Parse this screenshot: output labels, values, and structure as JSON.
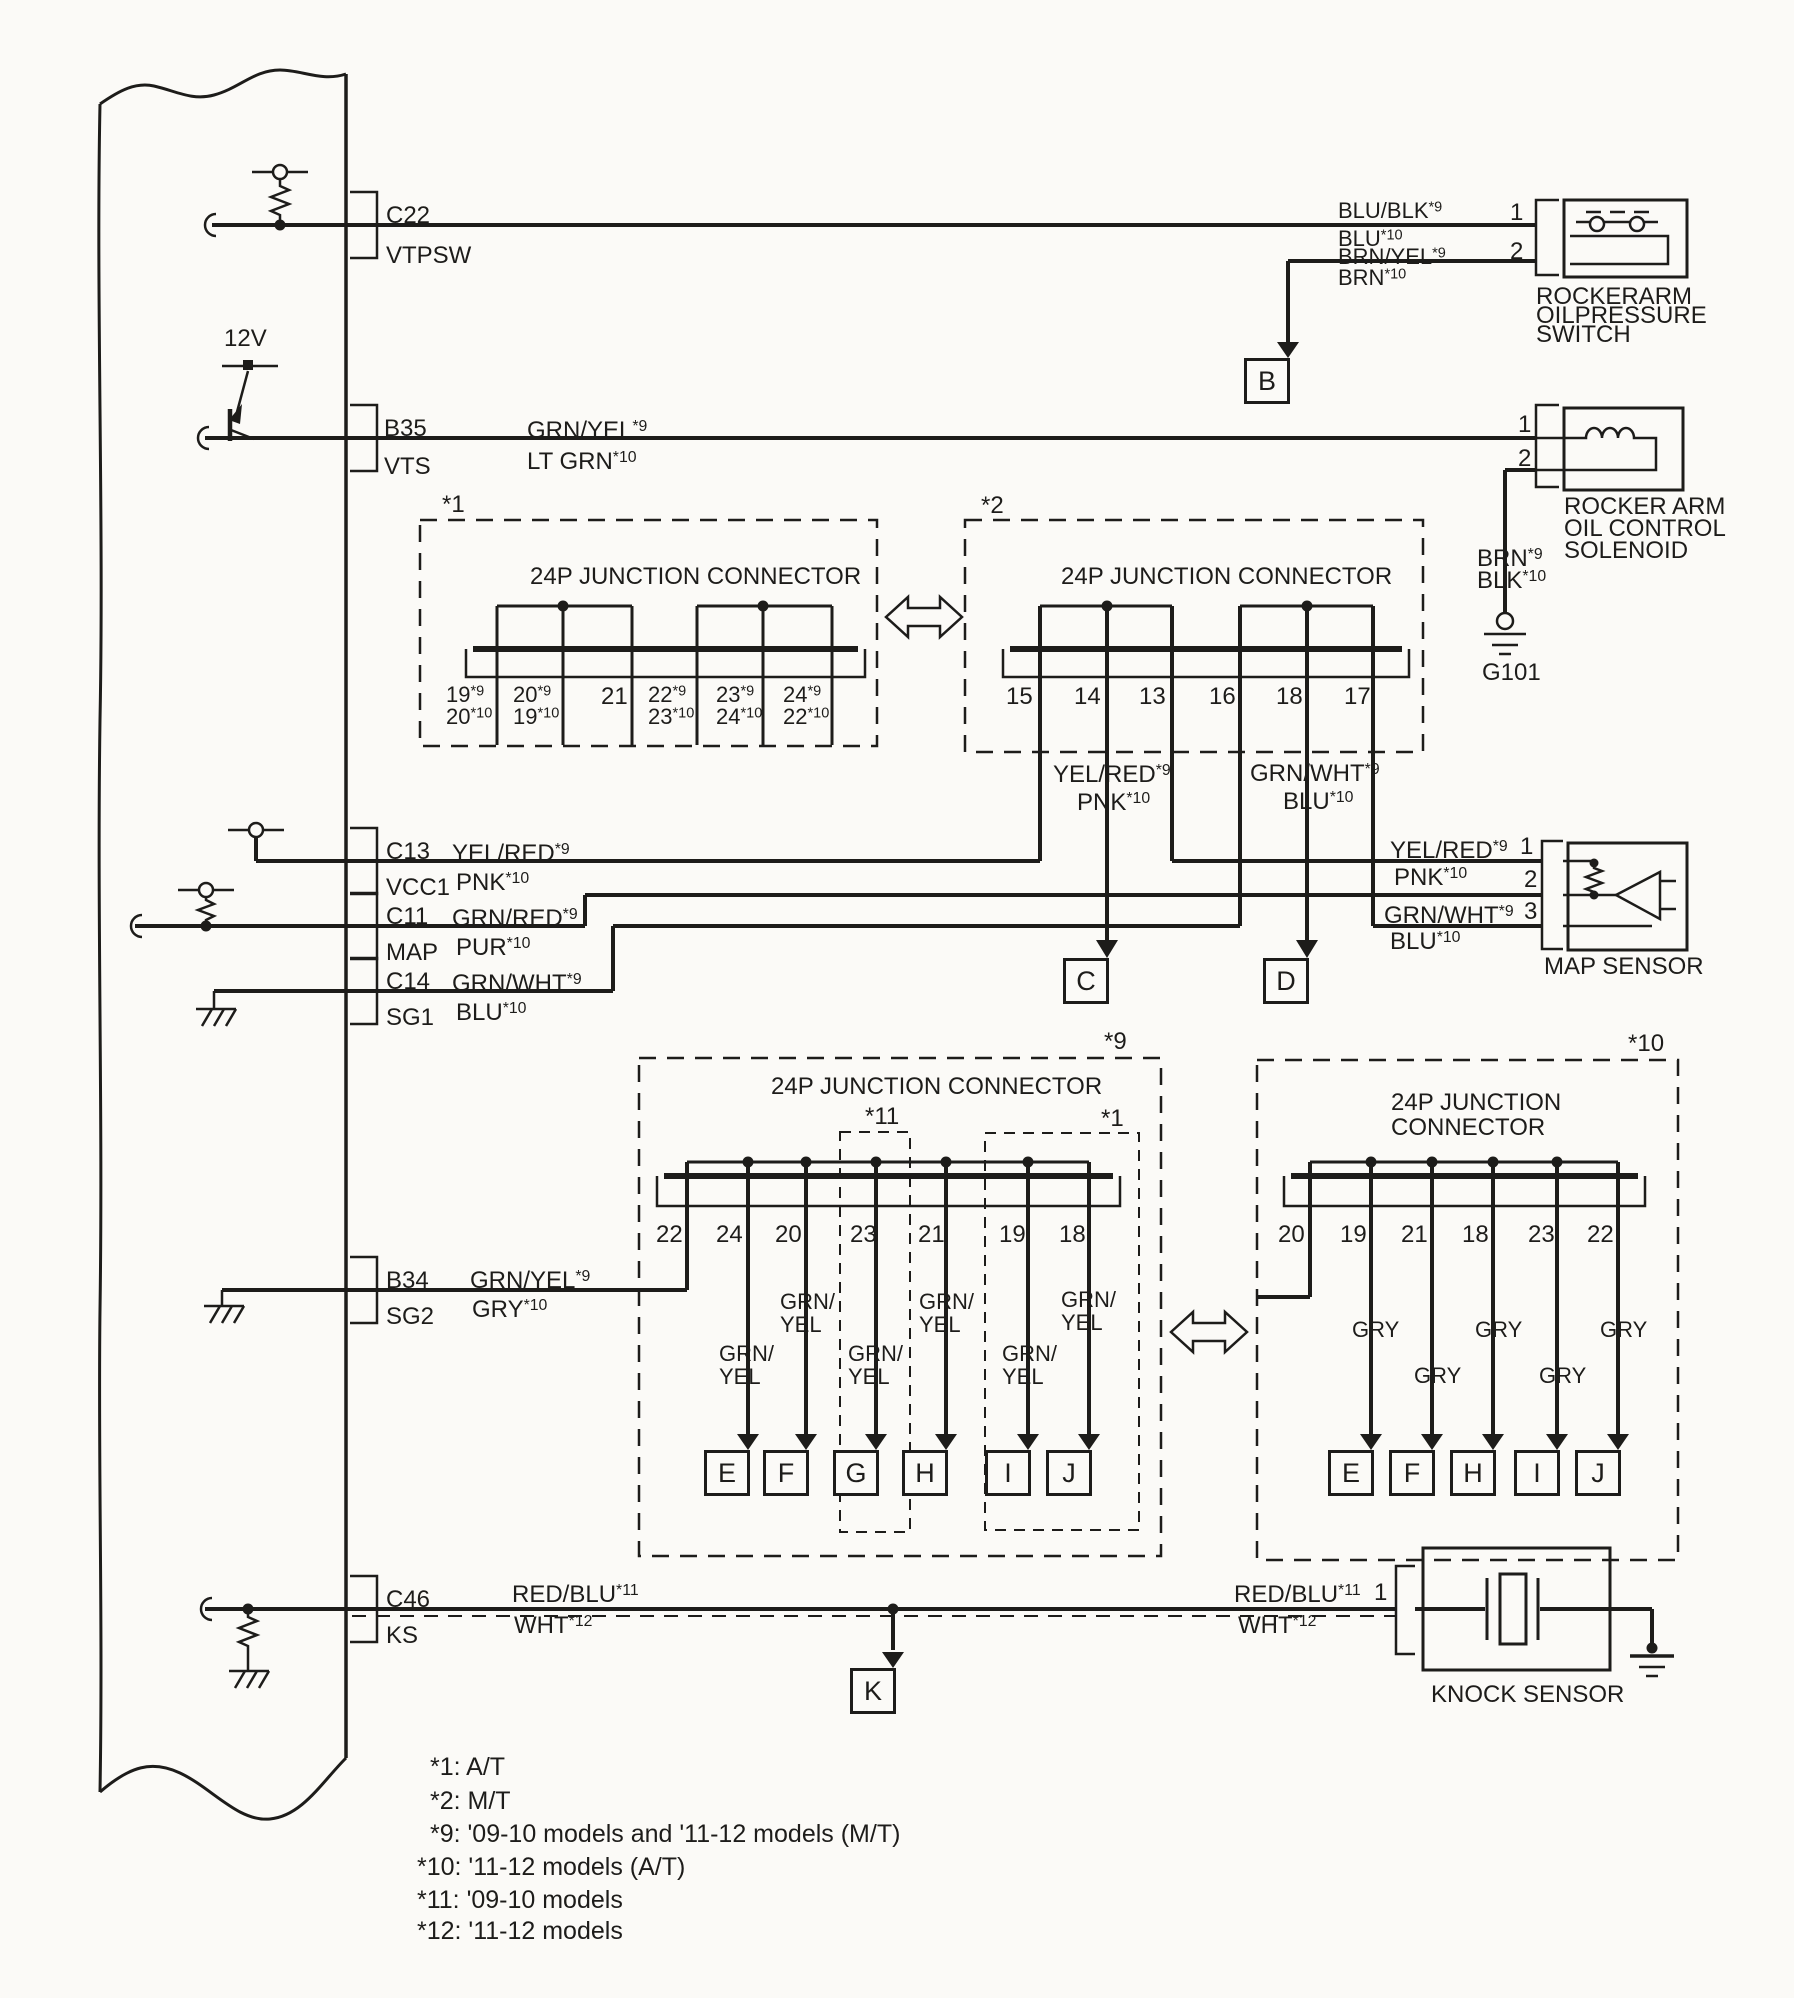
{
  "canvas": {
    "width": 1794,
    "height": 1998,
    "bg": "#fbfaf7",
    "ink": "#1d1c1a"
  },
  "labels": [
    {
      "n": "ecm-pin-c22-id",
      "t": "C22",
      "x": 386,
      "y": 203
    },
    {
      "n": "ecm-pin-c22-name",
      "t": "VTPSW",
      "x": 386,
      "y": 243
    },
    {
      "n": "supply-12v-label",
      "t": "12V",
      "x": 224,
      "y": 326
    },
    {
      "n": "ecm-pin-b35-id",
      "t": "B35",
      "x": 384,
      "y": 416
    },
    {
      "n": "ecm-pin-b35-name",
      "t": "VTS",
      "x": 384,
      "y": 454
    },
    {
      "n": "ecm-pin-c13-id",
      "t": "C13",
      "x": 386,
      "y": 839
    },
    {
      "n": "ecm-pin-c13-name",
      "t": "VCC1",
      "x": 386,
      "y": 875
    },
    {
      "n": "ecm-pin-c11-id",
      "t": "C11",
      "x": 386,
      "y": 904
    },
    {
      "n": "ecm-pin-c11-name",
      "t": "MAP",
      "x": 386,
      "y": 940
    },
    {
      "n": "ecm-pin-c14-id",
      "t": "C14",
      "x": 386,
      "y": 969
    },
    {
      "n": "ecm-pin-c14-name",
      "t": "SG1",
      "x": 386,
      "y": 1005
    },
    {
      "n": "ecm-pin-b34-id",
      "t": "B34",
      "x": 386,
      "y": 1268
    },
    {
      "n": "ecm-pin-b34-name",
      "t": "SG2",
      "x": 386,
      "y": 1304
    },
    {
      "n": "ecm-pin-c46-id",
      "t": "C46",
      "x": 386,
      "y": 1587
    },
    {
      "n": "ecm-pin-c46-name",
      "t": "KS",
      "x": 386,
      "y": 1623
    },
    {
      "n": "wire-vts-color-1",
      "t": "GRN/YEL*9",
      "x": 527,
      "y": 418
    },
    {
      "n": "wire-vts-color-2",
      "t": "LT GRN*10",
      "x": 527,
      "y": 449
    },
    {
      "n": "wire-vcc1-color-1",
      "t": "YEL/RED*9",
      "x": 452,
      "y": 841
    },
    {
      "n": "wire-vcc1-color-2",
      "t": "PNK*10",
      "x": 456,
      "y": 870
    },
    {
      "n": "wire-map-color-1",
      "t": "GRN/RED*9",
      "x": 452,
      "y": 906
    },
    {
      "n": "wire-map-color-2",
      "t": "PUR*10",
      "x": 456,
      "y": 935
    },
    {
      "n": "wire-sg1-color-1",
      "t": "GRN/WHT*9",
      "x": 452,
      "y": 971
    },
    {
      "n": "wire-sg1-color-2",
      "t": "BLU*10",
      "x": 456,
      "y": 1000
    },
    {
      "n": "wire-sg2-color-1",
      "t": "GRN/YEL*9",
      "x": 470,
      "y": 1268
    },
    {
      "n": "wire-sg2-color-2",
      "t": "GRY*10",
      "x": 472,
      "y": 1297
    },
    {
      "n": "wire-ks-color-1",
      "t": "RED/BLU*11",
      "x": 512,
      "y": 1582
    },
    {
      "n": "wire-ks-color-2",
      "t": "WHT*12",
      "x": 514,
      "y": 1613
    },
    {
      "n": "wire-vtpsw-color-1",
      "t": "BLU/BLK*9",
      "x": 1338,
      "y": 199,
      "s": 22
    },
    {
      "n": "wire-vtpsw-color-2",
      "t": "BLU*10",
      "x": 1338,
      "y": 227,
      "s": 22
    },
    {
      "n": "wire-vtpsw-color-3",
      "t": "BRN/YEL*9",
      "x": 1338,
      "y": 245,
      "s": 22
    },
    {
      "n": "wire-vtpsw-color-4",
      "t": "BRN*10",
      "x": 1338,
      "y": 266,
      "s": 22
    },
    {
      "n": "switch-pin-1",
      "t": "1",
      "x": 1510,
      "y": 200
    },
    {
      "n": "switch-pin-2",
      "t": "2",
      "x": 1510,
      "y": 239
    },
    {
      "n": "switch-caption-1",
      "t": "ROCKERARM",
      "x": 1536,
      "y": 284
    },
    {
      "n": "switch-caption-2",
      "t": "OILPRESSURE",
      "x": 1536,
      "y": 303
    },
    {
      "n": "switch-caption-3",
      "t": "SWITCH",
      "x": 1536,
      "y": 322
    },
    {
      "n": "solenoid-pin-1",
      "t": "1",
      "x": 1518,
      "y": 412
    },
    {
      "n": "solenoid-pin-2",
      "t": "2",
      "x": 1518,
      "y": 446
    },
    {
      "n": "solenoid-caption-1",
      "t": "ROCKER ARM",
      "x": 1564,
      "y": 494
    },
    {
      "n": "solenoid-caption-2",
      "t": "OIL CONTROL",
      "x": 1564,
      "y": 516
    },
    {
      "n": "solenoid-caption-3",
      "t": "SOLENOID",
      "x": 1564,
      "y": 538
    },
    {
      "n": "wire-solenoid-color-1",
      "t": "BRN*9",
      "x": 1477,
      "y": 546
    },
    {
      "n": "wire-solenoid-color-2",
      "t": "BLK*10",
      "x": 1477,
      "y": 568
    },
    {
      "n": "ground-g101-label",
      "t": "G101",
      "x": 1482,
      "y": 660
    },
    {
      "n": "jc1-tag",
      "t": "*1",
      "x": 442,
      "y": 492
    },
    {
      "n": "jc1-title",
      "t": "24P JUNCTION CONNECTOR",
      "x": 530,
      "y": 564
    },
    {
      "n": "jc1-pin-1",
      "t": "19*9\n20*10",
      "x": 446,
      "y": 684,
      "s": 22,
      "lh": 22
    },
    {
      "n": "jc1-pin-2",
      "t": "20*9\n19*10",
      "x": 513,
      "y": 684,
      "s": 22,
      "lh": 22
    },
    {
      "n": "jc1-pin-3",
      "t": "21",
      "x": 601,
      "y": 684,
      "s": 24
    },
    {
      "n": "jc1-pin-4",
      "t": "22*9\n23*10",
      "x": 648,
      "y": 684,
      "s": 22,
      "lh": 22
    },
    {
      "n": "jc1-pin-5",
      "t": "23*9\n24*10",
      "x": 716,
      "y": 684,
      "s": 22,
      "lh": 22
    },
    {
      "n": "jc1-pin-6",
      "t": "24*9\n22*10",
      "x": 783,
      "y": 684,
      "s": 22,
      "lh": 22
    },
    {
      "n": "jc2-tag",
      "t": "*2",
      "x": 981,
      "y": 493
    },
    {
      "n": "jc2-title",
      "t": "24P JUNCTION CONNECTOR",
      "x": 1061,
      "y": 564
    },
    {
      "n": "jc2-pin-15",
      "t": "15",
      "x": 1006,
      "y": 684
    },
    {
      "n": "jc2-pin-14",
      "t": "14",
      "x": 1074,
      "y": 684
    },
    {
      "n": "jc2-pin-13",
      "t": "13",
      "x": 1139,
      "y": 684
    },
    {
      "n": "jc2-pin-16",
      "t": "16",
      "x": 1209,
      "y": 684
    },
    {
      "n": "jc2-pin-18",
      "t": "18",
      "x": 1276,
      "y": 684
    },
    {
      "n": "jc2-pin-17",
      "t": "17",
      "x": 1344,
      "y": 684
    },
    {
      "n": "wire-jc2-c-1",
      "t": "YEL/RED*9",
      "x": 1053,
      "y": 762
    },
    {
      "n": "wire-jc2-c-2",
      "t": "PNK*10",
      "x": 1077,
      "y": 790
    },
    {
      "n": "wire-jc2-d-1",
      "t": "GRN/WHT*9",
      "x": 1250,
      "y": 761
    },
    {
      "n": "wire-jc2-d-2",
      "t": "BLU*10",
      "x": 1283,
      "y": 789
    },
    {
      "n": "wire-map1-color-1",
      "t": "YEL/RED*9",
      "x": 1390,
      "y": 838
    },
    {
      "n": "wire-map1-color-2",
      "t": "PNK*10",
      "x": 1394,
      "y": 865
    },
    {
      "n": "wire-map3-color-1",
      "t": "GRN/WHT*9",
      "x": 1384,
      "y": 903
    },
    {
      "n": "wire-map3-color-2",
      "t": "BLU*10",
      "x": 1390,
      "y": 929
    },
    {
      "n": "map-pin-1",
      "t": "1",
      "x": 1520,
      "y": 834
    },
    {
      "n": "map-pin-2",
      "t": "2",
      "x": 1524,
      "y": 867
    },
    {
      "n": "map-pin-3",
      "t": "3",
      "x": 1524,
      "y": 899
    },
    {
      "n": "map-caption",
      "t": "MAP SENSOR",
      "x": 1544,
      "y": 954
    },
    {
      "n": "jc9-tag",
      "t": "*9",
      "x": 1104,
      "y": 1029
    },
    {
      "n": "jc9-title",
      "t": "24P JUNCTION CONNECTOR",
      "x": 771,
      "y": 1074
    },
    {
      "n": "jc9-sub11-tag",
      "t": "*11",
      "x": 865,
      "y": 1104
    },
    {
      "n": "jc9-sub1-tag",
      "t": "*1",
      "x": 1101,
      "y": 1106
    },
    {
      "n": "jc9-pin-22",
      "t": "22",
      "x": 656,
      "y": 1222
    },
    {
      "n": "jc9-pin-24",
      "t": "24",
      "x": 716,
      "y": 1222
    },
    {
      "n": "jc9-pin-20",
      "t": "20",
      "x": 775,
      "y": 1222
    },
    {
      "n": "jc9-pin-23",
      "t": "23",
      "x": 850,
      "y": 1222
    },
    {
      "n": "jc9-pin-21",
      "t": "21",
      "x": 918,
      "y": 1222
    },
    {
      "n": "jc9-pin-19",
      "t": "19",
      "x": 999,
      "y": 1222
    },
    {
      "n": "jc9-pin-18",
      "t": "18",
      "x": 1059,
      "y": 1222
    },
    {
      "n": "wire-jc9-e",
      "t": "GRN/\nYEL",
      "x": 719,
      "y": 1342,
      "s": 22,
      "lh": 23
    },
    {
      "n": "wire-jc9-f",
      "t": "GRN/\nYEL",
      "x": 780,
      "y": 1290,
      "s": 22,
      "lh": 23
    },
    {
      "n": "wire-jc9-g",
      "t": "GRN/\nYEL",
      "x": 848,
      "y": 1342,
      "s": 22,
      "lh": 23
    },
    {
      "n": "wire-jc9-h",
      "t": "GRN/\nYEL",
      "x": 919,
      "y": 1290,
      "s": 22,
      "lh": 23
    },
    {
      "n": "wire-jc9-i",
      "t": "GRN/\nYEL",
      "x": 1002,
      "y": 1342,
      "s": 22,
      "lh": 23
    },
    {
      "n": "wire-jc9-j",
      "t": "GRN/\nYEL",
      "x": 1061,
      "y": 1288,
      "s": 22,
      "lh": 23
    },
    {
      "n": "jc10-tag",
      "t": "*10",
      "x": 1628,
      "y": 1031
    },
    {
      "n": "jc10-title",
      "t": "24P JUNCTION\nCONNECTOR",
      "x": 1391,
      "y": 1090,
      "lh": 25
    },
    {
      "n": "jc10-pin-20",
      "t": "20",
      "x": 1278,
      "y": 1222
    },
    {
      "n": "jc10-pin-19",
      "t": "19",
      "x": 1340,
      "y": 1222
    },
    {
      "n": "jc10-pin-21",
      "t": "21",
      "x": 1401,
      "y": 1222
    },
    {
      "n": "jc10-pin-18",
      "t": "18",
      "x": 1462,
      "y": 1222
    },
    {
      "n": "jc10-pin-23",
      "t": "23",
      "x": 1528,
      "y": 1222
    },
    {
      "n": "jc10-pin-22",
      "t": "22",
      "x": 1587,
      "y": 1222
    },
    {
      "n": "wire-jc10-e",
      "t": "GRY",
      "x": 1352,
      "y": 1318,
      "s": 22
    },
    {
      "n": "wire-jc10-f",
      "t": "GRY",
      "x": 1414,
      "y": 1364,
      "s": 22
    },
    {
      "n": "wire-jc10-h",
      "t": "GRY",
      "x": 1475,
      "y": 1318,
      "s": 22
    },
    {
      "n": "wire-jc10-i",
      "t": "GRY",
      "x": 1539,
      "y": 1364,
      "s": 22
    },
    {
      "n": "wire-jc10-j",
      "t": "GRY",
      "x": 1600,
      "y": 1318,
      "s": 22
    },
    {
      "n": "wire-ks-right-color-1",
      "t": "RED/BLU*11",
      "x": 1234,
      "y": 1582
    },
    {
      "n": "wire-ks-right-color-2",
      "t": "WHT*12",
      "x": 1238,
      "y": 1613
    },
    {
      "n": "knock-pin-1",
      "t": "1",
      "x": 1374,
      "y": 1580
    },
    {
      "n": "knock-caption",
      "t": "KNOCK SENSOR",
      "x": 1431,
      "y": 1682
    },
    {
      "n": "footnote-1",
      "t": "*1: A/T",
      "x": 430,
      "y": 1754,
      "s": 25
    },
    {
      "n": "footnote-2",
      "t": "*2: M/T",
      "x": 430,
      "y": 1788,
      "s": 25
    },
    {
      "n": "footnote-9",
      "t": "*9: '09-10 models and '11-12 models (M/T)",
      "x": 430,
      "y": 1821,
      "s": 25
    },
    {
      "n": "footnote-10",
      "t": "*10: '11-12 models (A/T)",
      "x": 417,
      "y": 1854,
      "s": 25
    },
    {
      "n": "footnote-11",
      "t": "*11: '09-10 models",
      "x": 417,
      "y": 1887,
      "s": 25
    },
    {
      "n": "footnote-12",
      "t": "*12: '11-12 models",
      "x": 417,
      "y": 1918,
      "s": 25
    }
  ],
  "ref_boxes": [
    {
      "n": "ref-box-b",
      "t": "B",
      "x": 1266,
      "y": 358
    },
    {
      "n": "ref-box-c",
      "t": "C",
      "x": 1085,
      "y": 958
    },
    {
      "n": "ref-box-d",
      "t": "D",
      "x": 1285,
      "y": 958
    },
    {
      "n": "ref-box-e-1",
      "t": "E",
      "x": 726,
      "y": 1450
    },
    {
      "n": "ref-box-f-1",
      "t": "F",
      "x": 785,
      "y": 1450
    },
    {
      "n": "ref-box-g-1",
      "t": "G",
      "x": 855,
      "y": 1450
    },
    {
      "n": "ref-box-h-1",
      "t": "H",
      "x": 924,
      "y": 1450
    },
    {
      "n": "ref-box-i-1",
      "t": "I",
      "x": 1007,
      "y": 1450
    },
    {
      "n": "ref-box-j-1",
      "t": "J",
      "x": 1068,
      "y": 1450
    },
    {
      "n": "ref-box-e-2",
      "t": "E",
      "x": 1350,
      "y": 1450
    },
    {
      "n": "ref-box-f-2",
      "t": "F",
      "x": 1411,
      "y": 1450
    },
    {
      "n": "ref-box-h-2",
      "t": "H",
      "x": 1472,
      "y": 1450
    },
    {
      "n": "ref-box-i-2",
      "t": "I",
      "x": 1536,
      "y": 1450
    },
    {
      "n": "ref-box-j-2",
      "t": "J",
      "x": 1597,
      "y": 1450
    },
    {
      "n": "ref-box-k",
      "t": "K",
      "x": 872,
      "y": 1668
    }
  ]
}
